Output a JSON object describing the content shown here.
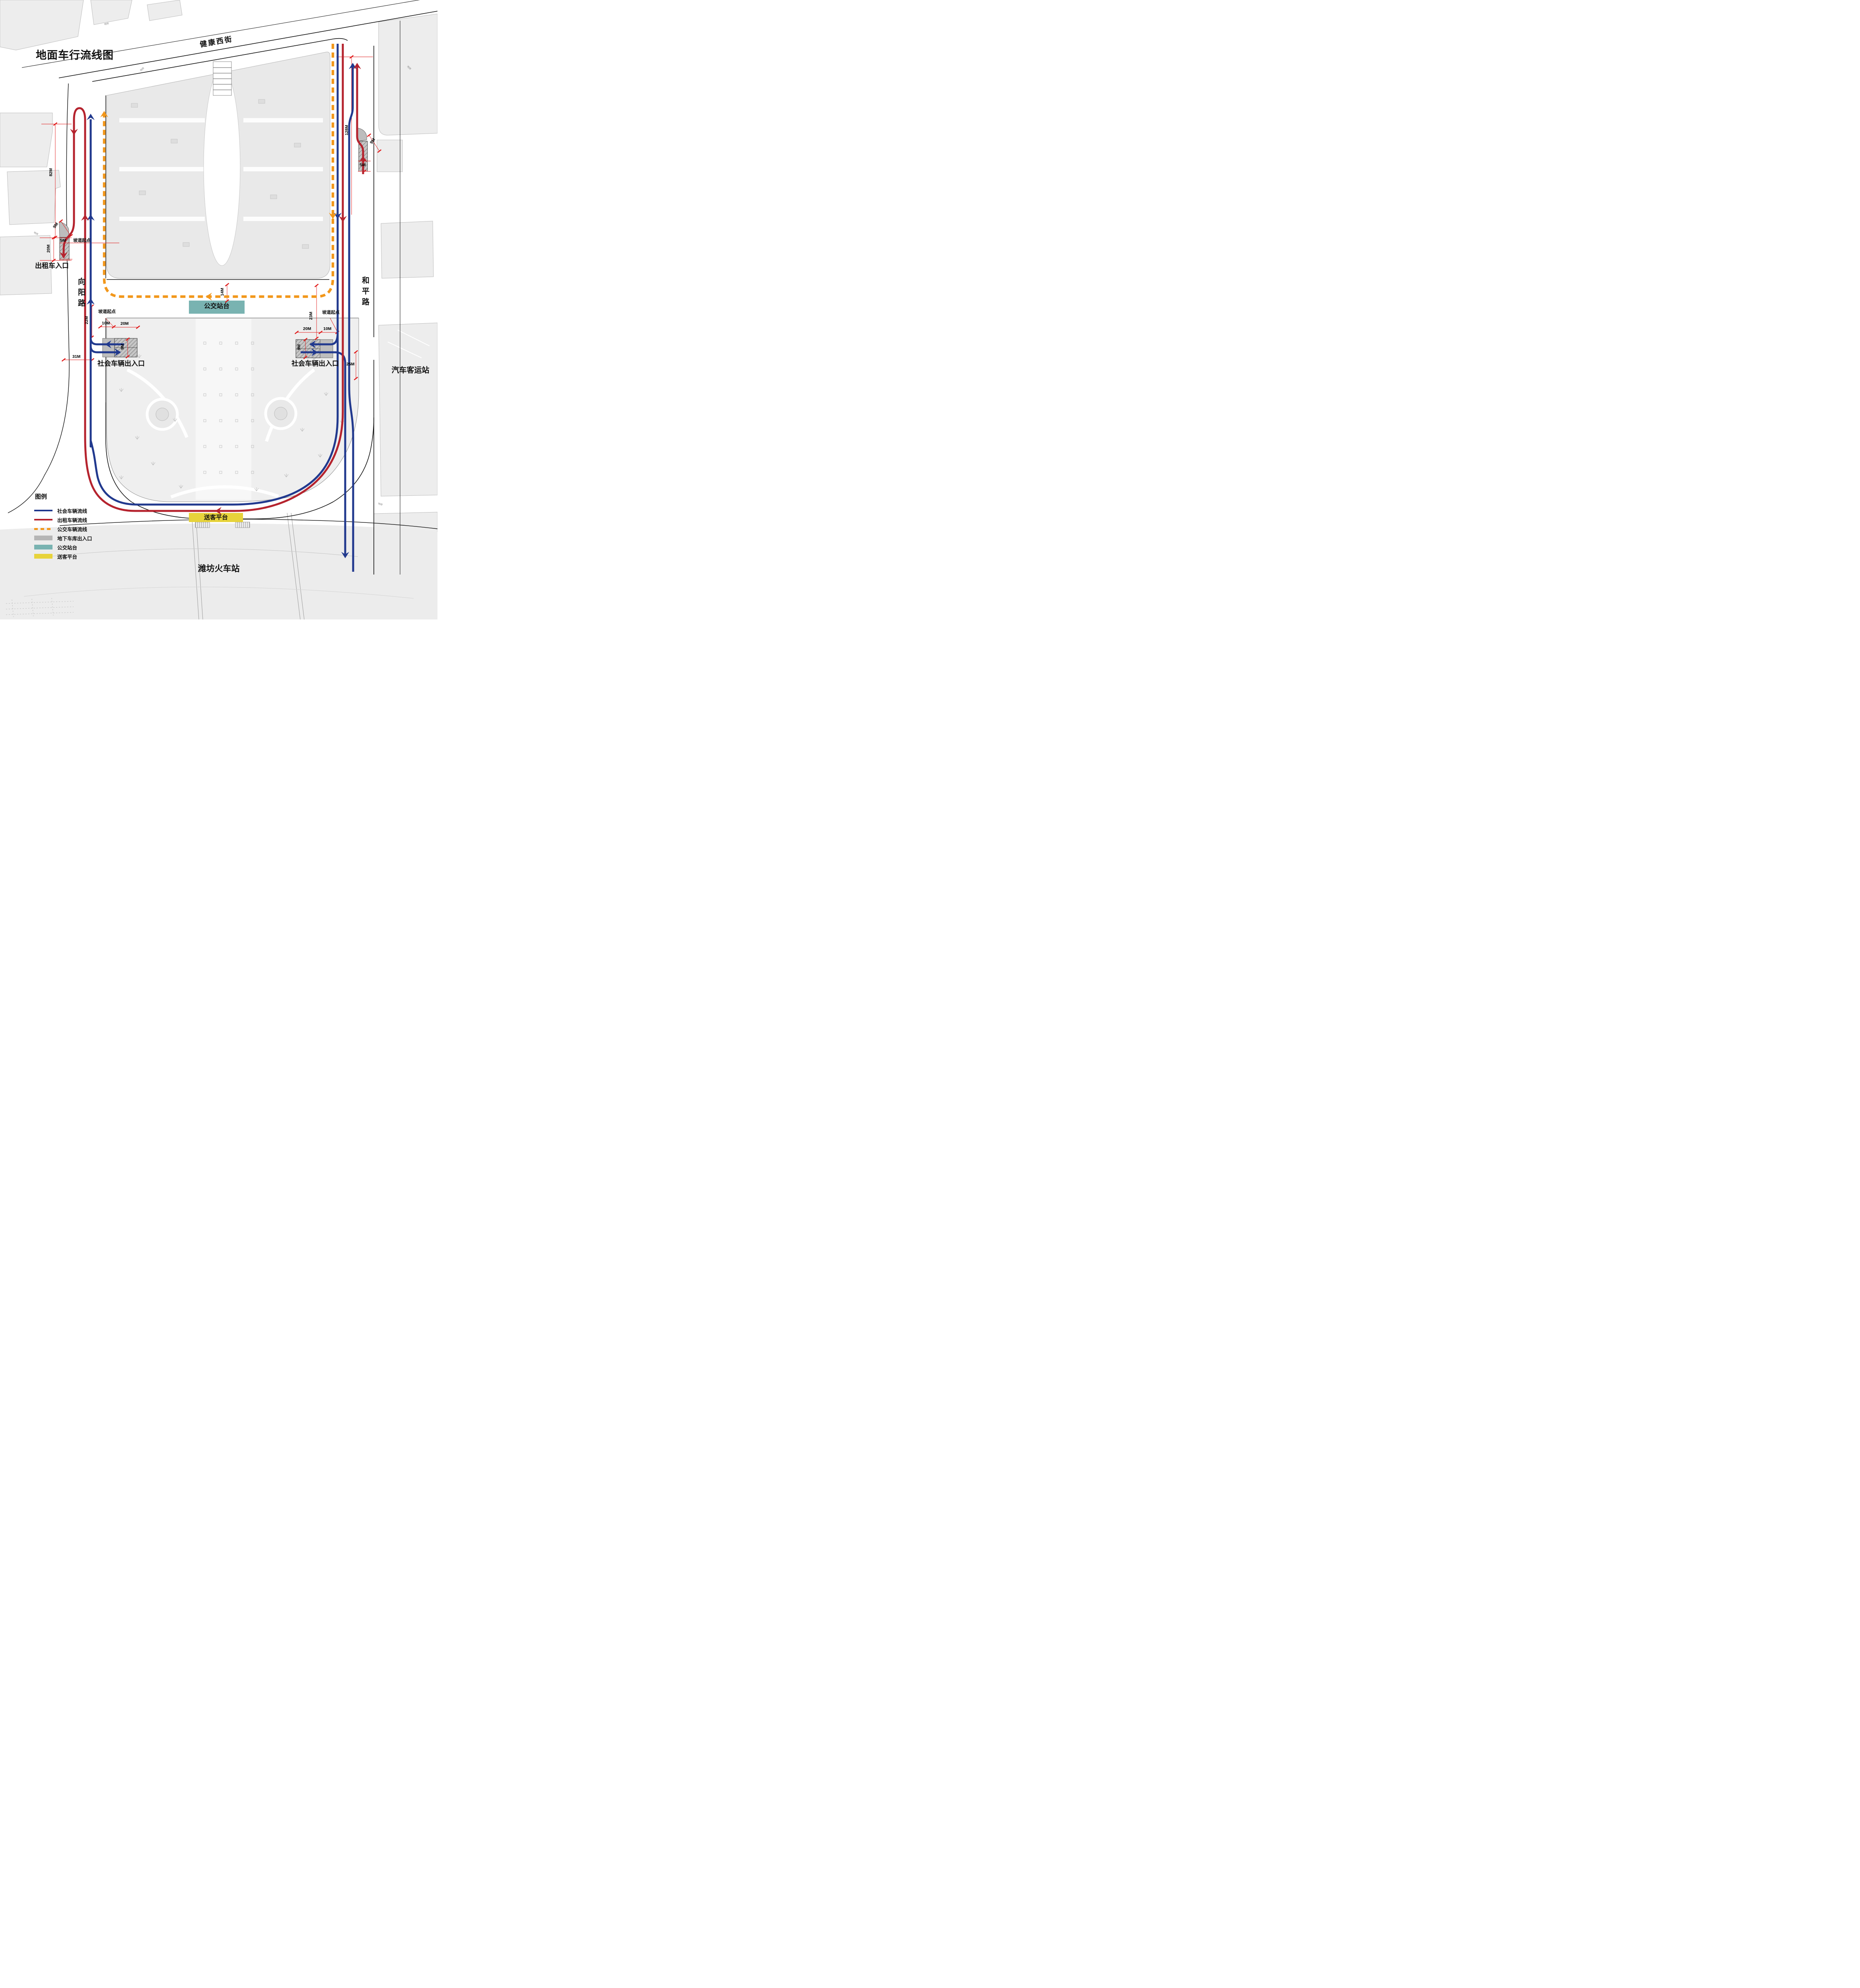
{
  "title": "地面车行流线图",
  "streets": {
    "top": "健康西街",
    "left": "向阳路",
    "right": "和平路"
  },
  "places": {
    "railway_station": "潍坊火车站",
    "bus_terminal": "汽车客运站",
    "taxi_entrance": "出租车入口",
    "social_entrance_left": "社会车辆出入口",
    "social_entrance_right": "社会车辆出入口",
    "bus_platform": "公交站台",
    "dropoff_platform": "送客平台"
  },
  "annotations": {
    "ramp_start": "坡道起点",
    "ground_brick": "地砖"
  },
  "dimensions": {
    "d82": "82M",
    "d9_taxi": "9M",
    "d5_taxi": "5M",
    "d20_taxi": "20M",
    "d22": "22M",
    "d10_left": "10M",
    "d20_left": "20M",
    "d9_left": "9M",
    "d31": "31M",
    "d14": "14M",
    "d23": "23M",
    "d20_right": "20M",
    "d10_right": "10M",
    "d9_right": "9M",
    "d25": "25M",
    "d128": "128M",
    "d5_right": "5M",
    "d9_topright": "9M"
  },
  "legend": {
    "title": "图例",
    "items": [
      {
        "label": "社会车辆流线",
        "type": "line-blue"
      },
      {
        "label": "出租车辆流线",
        "type": "line-red"
      },
      {
        "label": "公交车辆流线",
        "type": "dash-orange"
      },
      {
        "label": "地下车库出入口",
        "type": "rect-gray"
      },
      {
        "label": "公交站台",
        "type": "rect-teal"
      },
      {
        "label": "送客平台",
        "type": "rect-yellow"
      }
    ]
  },
  "colors": {
    "social_flow": "#21398e",
    "taxi_flow": "#b5232e",
    "bus_flow": "#f2971b",
    "bus_platform": "#79b3b1",
    "dropoff_platform": "#e7d33b",
    "garage": "#c2c2c2",
    "dimension": "#e01818"
  }
}
